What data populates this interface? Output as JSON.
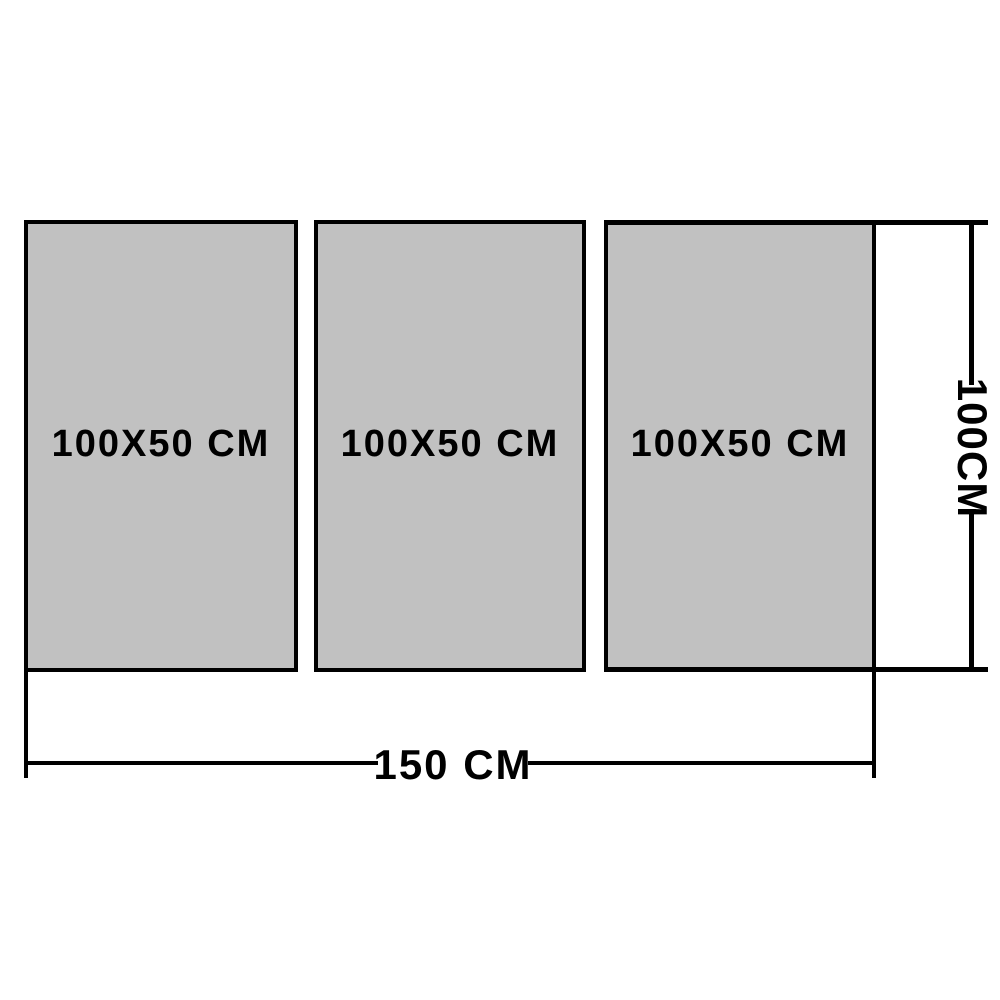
{
  "diagram": {
    "title": "triptych-canvas-size-diagram",
    "panels": [
      {
        "label": "100X50 CM"
      },
      {
        "label": "100X50 CM"
      },
      {
        "label": "100X50 CM"
      }
    ],
    "width_dimension": {
      "label": "150 CM"
    },
    "height_dimension": {
      "label": "100CM"
    },
    "colors": {
      "panel_fill": "#c1c1c1",
      "line": "#000000",
      "background": "#ffffff"
    }
  }
}
